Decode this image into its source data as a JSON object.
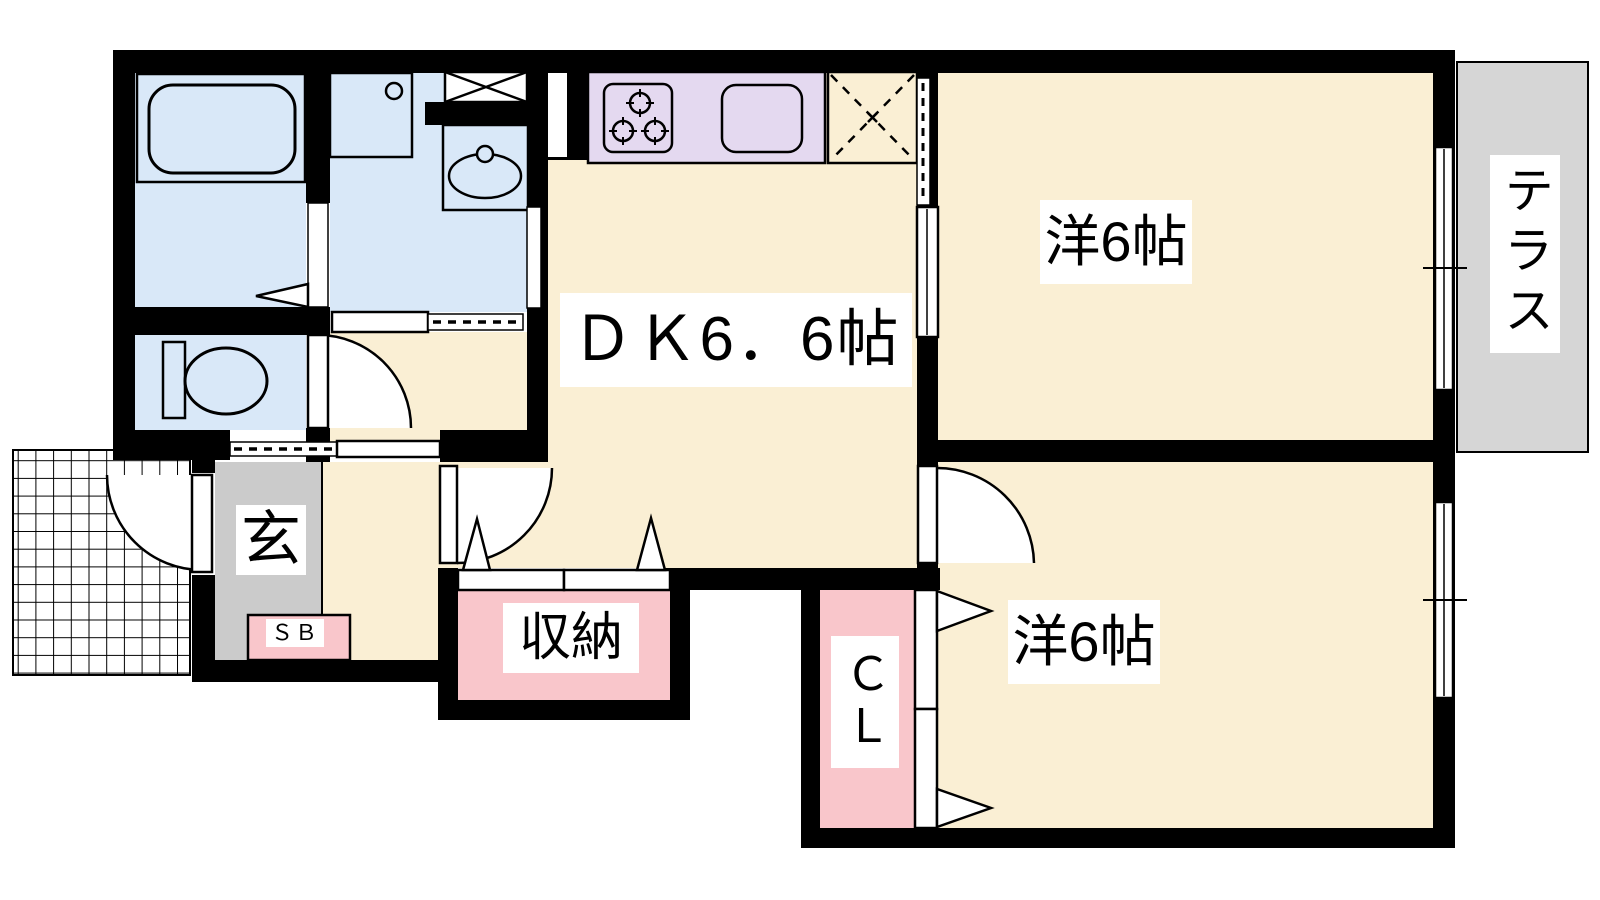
{
  "title": "1DK+2 apartment floor plan",
  "labels": {
    "dk": "ＤＫ6．6帖",
    "room_top": "洋6帖",
    "room_bottom": "洋6帖",
    "terrace": "テラス",
    "entrance": "玄",
    "shoe_box": "ＳＢ",
    "storage": "収納",
    "closet": "ＣＬ"
  },
  "rooms": [
    {
      "id": "dining-kitchen",
      "label": "ＤＫ6．6帖",
      "size_jo": 6.6
    },
    {
      "id": "western-room-top",
      "label": "洋6帖",
      "size_jo": 6
    },
    {
      "id": "western-room-bottom",
      "label": "洋6帖",
      "size_jo": 6
    },
    {
      "id": "terrace",
      "label": "テラス"
    },
    {
      "id": "entrance",
      "label": "玄"
    },
    {
      "id": "shoe-box",
      "label": "ＳＢ"
    },
    {
      "id": "storage",
      "label": "収納"
    },
    {
      "id": "closet",
      "label": "ＣＬ"
    }
  ],
  "colors": {
    "wall": "#000000",
    "floor_cream": "#FAEFD4",
    "wet_area_blue": "#D9E8F8",
    "kitchen_purple": "#E4D9F0",
    "closet_pink": "#F9C6CB",
    "entrance_gray": "#CBCBCB",
    "terrace_gray": "#D6D6D6",
    "background": "#FFFFFF"
  }
}
